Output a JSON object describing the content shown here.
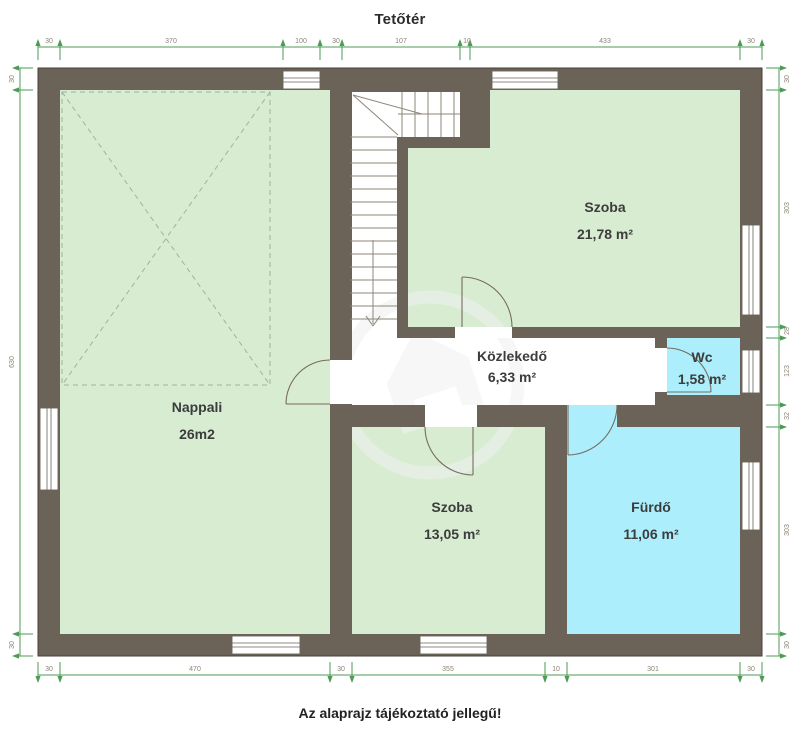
{
  "page": {
    "title": "Tetőtér",
    "note": "Az alaprajz tájékoztató jellegű!"
  },
  "rooms": [
    {
      "name": "Nappali",
      "area": "26m2"
    },
    {
      "name": "Szoba",
      "area": "21,78 m²"
    },
    {
      "name": "Közlekedő",
      "area": "6,33 m²"
    },
    {
      "name": "Wc",
      "area": "1,58 m²"
    },
    {
      "name": "Szoba",
      "area": "13,05 m²"
    },
    {
      "name": "Fürdő",
      "area": "11,06 m²"
    }
  ],
  "dimensions": {
    "top": [
      "30",
      "370",
      "100",
      "30",
      "107",
      "10",
      "433",
      "30"
    ],
    "bottom": [
      "30",
      "470",
      "30",
      "355",
      "10",
      "301",
      "30"
    ],
    "left": [
      "30",
      "630",
      "30"
    ],
    "right": [
      "30",
      "303",
      "28",
      "123",
      "32",
      "303",
      "30"
    ]
  },
  "icons": {
    "watermark": "house-watermark-icon"
  },
  "colors": {
    "wall": "#6b6357",
    "green": "#d8ecd2",
    "cyan": "#aceefb",
    "dim": "#4e9b55",
    "dimtext": "#8c8374",
    "line": "#756d60",
    "stair": "#8e8679",
    "dash": "#a3b299",
    "text": "#3c3c3c"
  }
}
